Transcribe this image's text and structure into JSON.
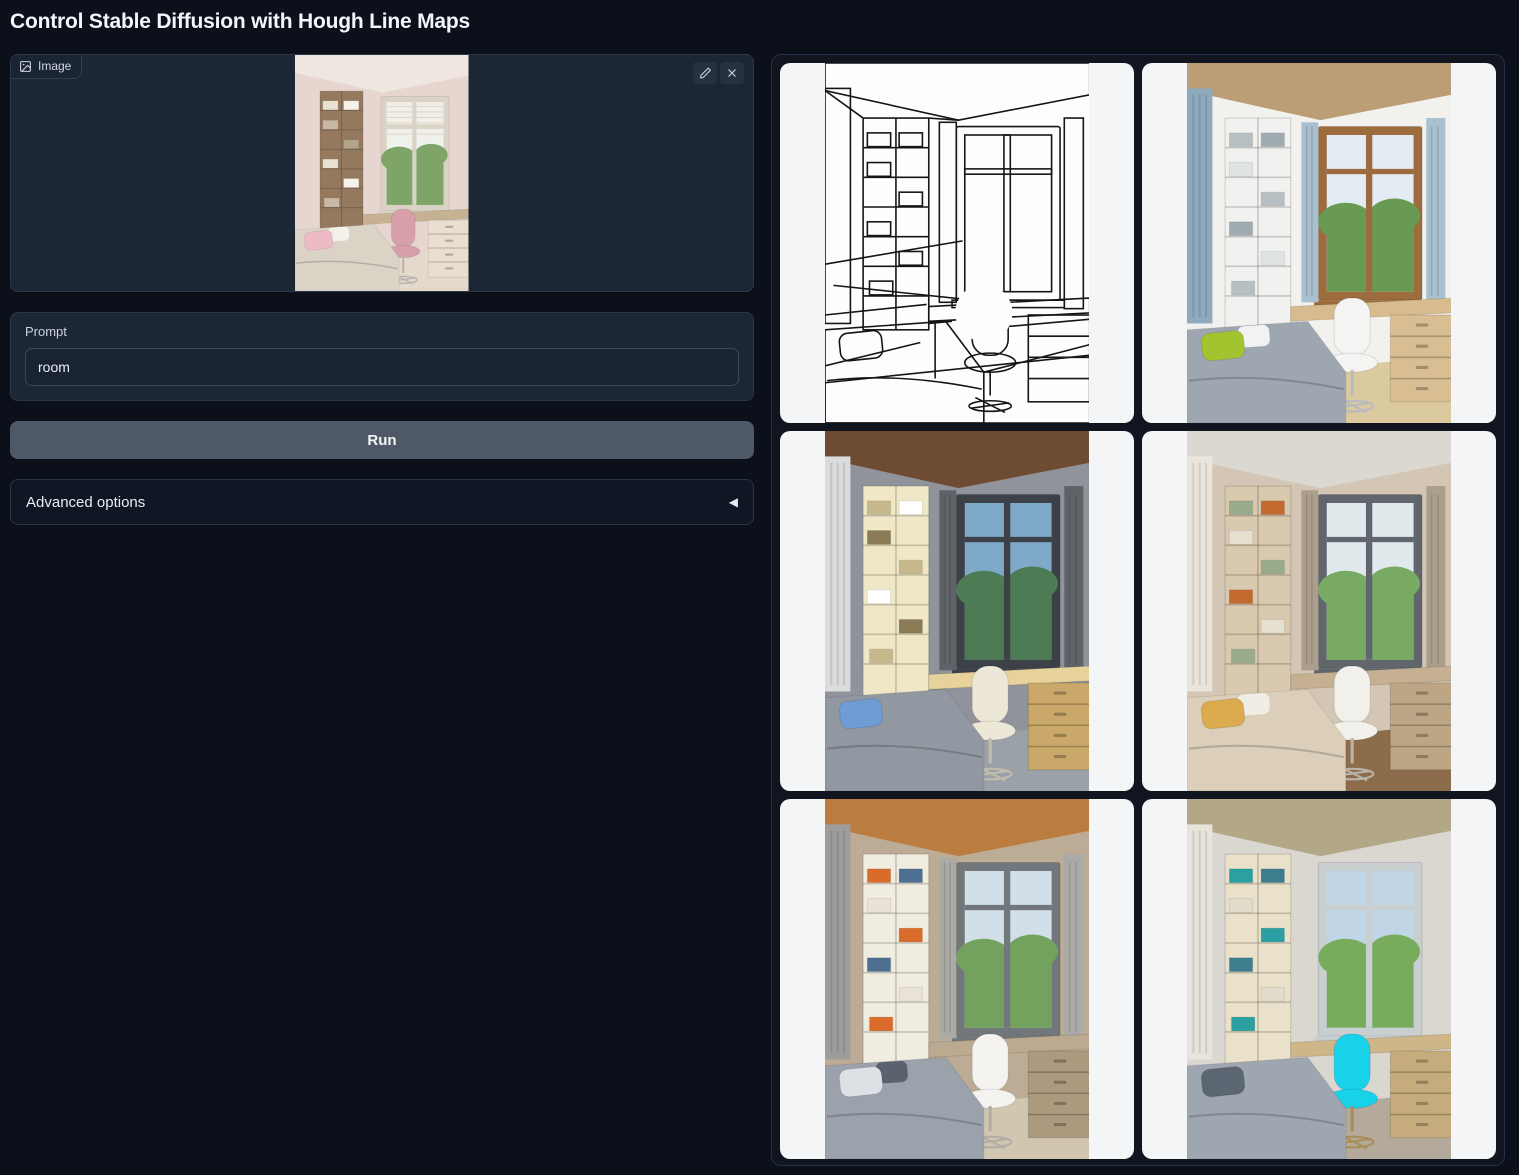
{
  "title": "Control Stable Diffusion with Hough Line Maps",
  "input_panel": {
    "label": "Image"
  },
  "prompt": {
    "label": "Prompt",
    "value": "room"
  },
  "run_label": "Run",
  "advanced": {
    "label": "Advanced options",
    "collapse_arrow": "◀"
  },
  "ui_colors": {
    "page_bg": "#0c101b",
    "block_bg": "#1d2635",
    "block_border": "#2c3748",
    "run_button_bg": "#4e5866",
    "gallery_bg": "#10151f",
    "gallery_cell_bg": "#f3f5f7",
    "text_light": "#f2f5f9"
  },
  "input_image": {
    "name": "uploaded-room-photo",
    "mode": "render",
    "palette": {
      "wall": "#e6d6cf",
      "ceiling": "#efe6df",
      "left_drape": null,
      "shelf_face": "#94795f",
      "books": [
        "#e9e2d2",
        "#f6f2ea",
        "#c9b9a4",
        "#b3a28c"
      ],
      "frame": "#d9d3c6",
      "sky": "#eef2ec",
      "greenery": "#7fa468",
      "blind": true,
      "curtain": null,
      "desk": "#c7b193",
      "drawers": "#e8dfcf",
      "chair": "#d69fa9",
      "chair_leg": "#b9b4ad",
      "bed": "#dcd3c7",
      "pillow": "#eebac6",
      "pillow2": "#f4f1ec",
      "floor": "#e3dacb"
    }
  },
  "gallery": {
    "items": [
      {
        "name": "hough-line-map",
        "mode": "lines",
        "palette": {
          "wall": "#ffffff",
          "ceiling": "#ffffff",
          "left_drape": null,
          "shelf_face": "#ffffff",
          "books": [
            "#ffffff"
          ],
          "frame": "#ffffff",
          "sky": "#ffffff",
          "greenery": "#ffffff",
          "blind": false,
          "curtain": "#ffffff",
          "desk": "#ffffff",
          "drawers": "#ffffff",
          "chair": "#ffffff",
          "chair_leg": "#151515",
          "bed": "#ffffff",
          "pillow": "#ffffff",
          "pillow2": null,
          "floor": "#ffffff"
        }
      },
      {
        "name": "generated-room-blue-curtains",
        "mode": "render",
        "palette": {
          "wall": "#f2f1ed",
          "ceiling": "#bb9e76",
          "left_drape": "#8fa9bd",
          "shelf_face": "#f1f1ef",
          "books": [
            "#b7bfc3",
            "#9fabb1",
            "#dfe3e4"
          ],
          "frame": "#9c6c3e",
          "sky": "#e3ecf2",
          "greenery": "#689a53",
          "blind": false,
          "curtain": "#a9c0d0",
          "desk": "#d8bb8e",
          "drawers": "#d9be93",
          "chair": "#f4f4f2",
          "chair_leg": "#b9bcbf",
          "bed": "#9ea7b1",
          "pillow": "#a2c52f",
          "pillow2": "#f0f2f4",
          "floor": "#dbca9f"
        }
      },
      {
        "name": "generated-room-sea-view",
        "mode": "render",
        "palette": {
          "wall": "#90939a",
          "ceiling": "#6e4c34",
          "left_drape": "#dcdcdc",
          "shelf_face": "#efe7c6",
          "books": [
            "#c8b88e",
            "#ffffff",
            "#8a7a55"
          ],
          "frame": "#3c4147",
          "sky": "#7fa9c9",
          "greenery": "#4d7c54",
          "blind": false,
          "curtain": "#5f6368",
          "desk": "#e6d29a",
          "drawers": "#c9a869",
          "chair": "#ece7d6",
          "chair_leg": "#c2bcae",
          "bed": "#9298a1",
          "pillow": "#6f9cd4",
          "pillow2": null,
          "floor": "#9ba1a8"
        }
      },
      {
        "name": "generated-room-tan",
        "mode": "render",
        "palette": {
          "wall": "#d3c6b4",
          "ceiling": "#dbd8d2",
          "left_drape": "#eae5dc",
          "shelf_face": "#d9c9ae",
          "books": [
            "#9aab8c",
            "#c46a31",
            "#e6e0d2"
          ],
          "frame": "#60666b",
          "sky": "#e2e9ec",
          "greenery": "#78aa64",
          "blind": false,
          "curtain": "#ab9e8c",
          "desk": "#c5b092",
          "drawers": "#bca685",
          "chair": "#f1f0ea",
          "chair_leg": "#b9b4aa",
          "bed": "#dbcfba",
          "pillow": "#dcab4e",
          "pillow2": "#f1ede4",
          "floor": "#8d6c4c"
        }
      },
      {
        "name": "generated-room-wood-ceiling",
        "mode": "render",
        "palette": {
          "wall": "#bcab95",
          "ceiling": "#bb7c40",
          "left_drape": "#9d9d9b",
          "shelf_face": "#f1ece0",
          "books": [
            "#d96c2b",
            "#4d7090",
            "#e8e3d6"
          ],
          "frame": "#71777a",
          "sky": "#d2dfe8",
          "greenery": "#72a25e",
          "blind": false,
          "curtain": "#aaaaa6",
          "desk": "#bbaa90",
          "drawers": "#ab9a7e",
          "chair": "#f5f3ef",
          "chair_leg": "#b2aea6",
          "bed": "#9ca2ac",
          "pillow": "#dde1e6",
          "pillow2": "#5a6270",
          "floor": "#d1c6b0"
        }
      },
      {
        "name": "generated-room-cyan-chair",
        "mode": "render",
        "palette": {
          "wall": "#dad7d1",
          "ceiling": "#b2a786",
          "left_drape": "#e7e4dc",
          "shelf_face": "#e9e1c9",
          "books": [
            "#2aa0a2",
            "#3d7e8e",
            "#e2dccb"
          ],
          "frame": "#c9ced1",
          "sky": "#c0d6e7",
          "greenery": "#77ac5d",
          "blind": false,
          "curtain": null,
          "desk": "#cfb689",
          "drawers": "#c6ac7c",
          "chair": "#18d2e9",
          "chair_leg": "#a98d5a",
          "bed": "#9ea6b0",
          "pillow": "#5c6672",
          "pillow2": null,
          "floor": "#b3aa9c"
        }
      }
    ]
  }
}
